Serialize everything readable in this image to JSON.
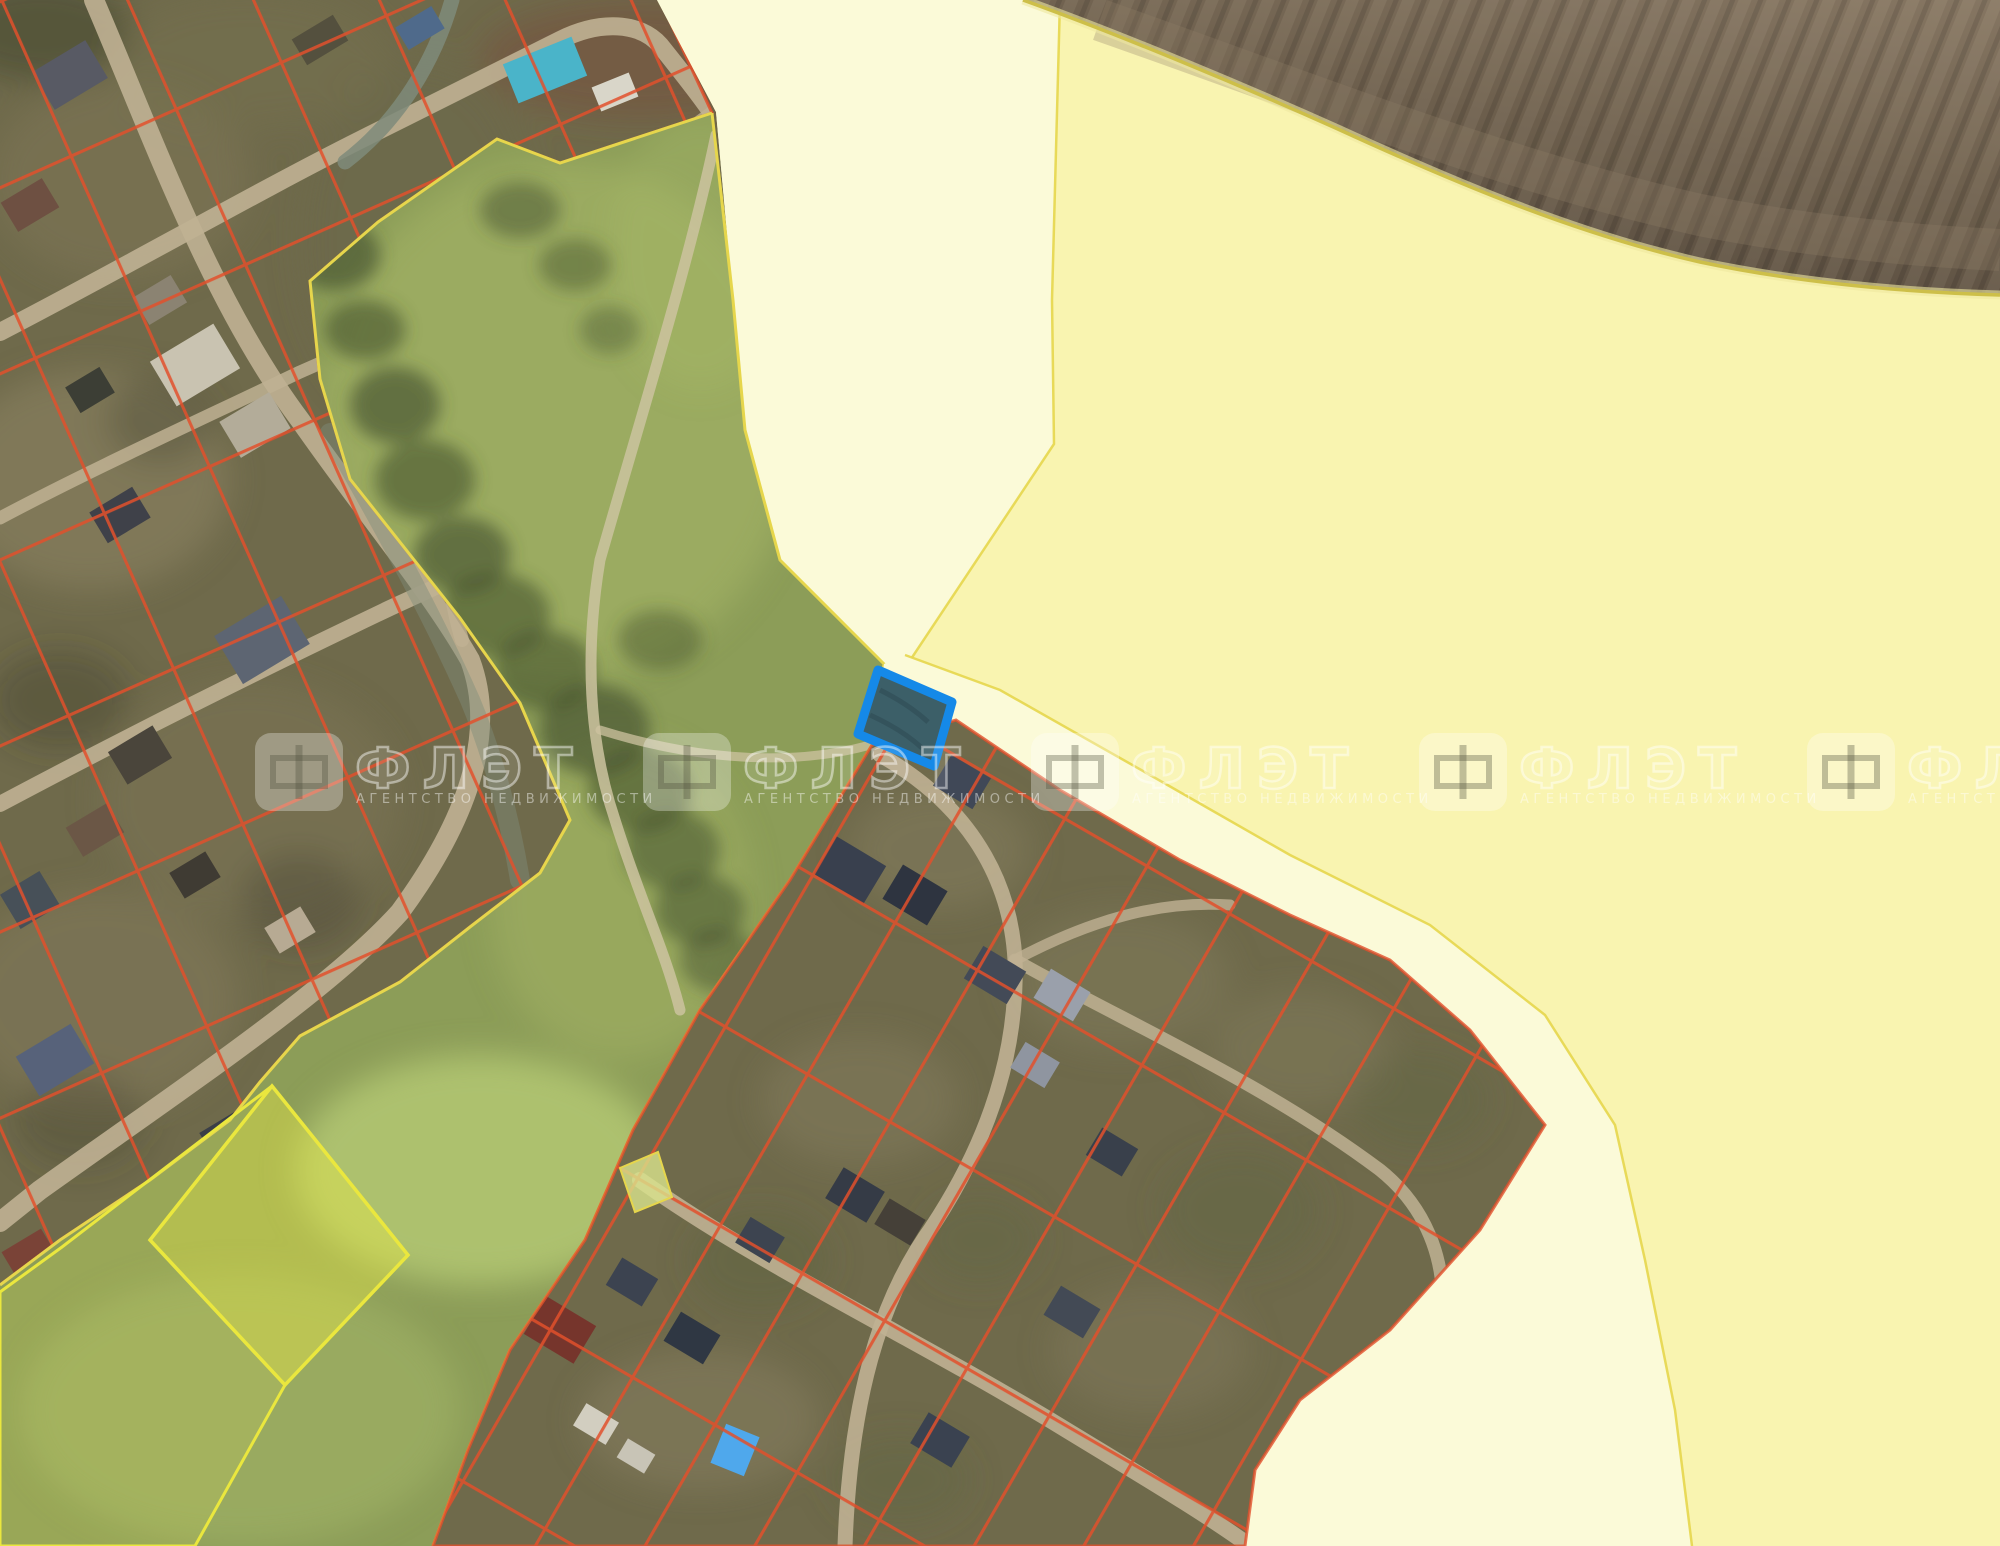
{
  "map": {
    "kind": "cadastral-satellite-map",
    "watermark": {
      "logo_glyph": "Ф",
      "title": "ФЛЭТ",
      "subtitle": "АГЕНТСТВО НЕДВИЖИМОСТИ"
    },
    "selected_parcel": {
      "fill": "#3c5f68",
      "border": "#1589e8"
    },
    "palette": {
      "cad_red": "#e2502c",
      "line_yellow": "#e6d64c",
      "zone_green": "#8c9d58",
      "zone_green_dark": "#46522f",
      "zone_green_light": "#a9ba6a",
      "pond_green": "#b5ca74",
      "agri_light": "#fbfad8",
      "agri_main": "#f9f4b0",
      "field_dark": "#50453a",
      "field_mid": "#6c5e4c",
      "field_light": "#8a7a66",
      "field_line": "#cdbf49",
      "village_ground": "#6f6a4b",
      "road_tan": "#c0b193",
      "path_tan": "#cdc3a0",
      "stream_gray": "#7f8b7a",
      "watermark_white": "rgba(255,255,255,0.45)",
      "watermark_soft": "rgba(255,255,255,0.30)",
      "watermark_ink": "rgba(80,80,60,0.35)",
      "highlight_border": "#eae73e",
      "highlight_fill": "rgba(233,233,70,0.42)",
      "highlight_fill_dim": "rgba(225,228,90,0.15)",
      "mini_parcel_fill": "rgba(217,227,140,0.8)"
    }
  }
}
